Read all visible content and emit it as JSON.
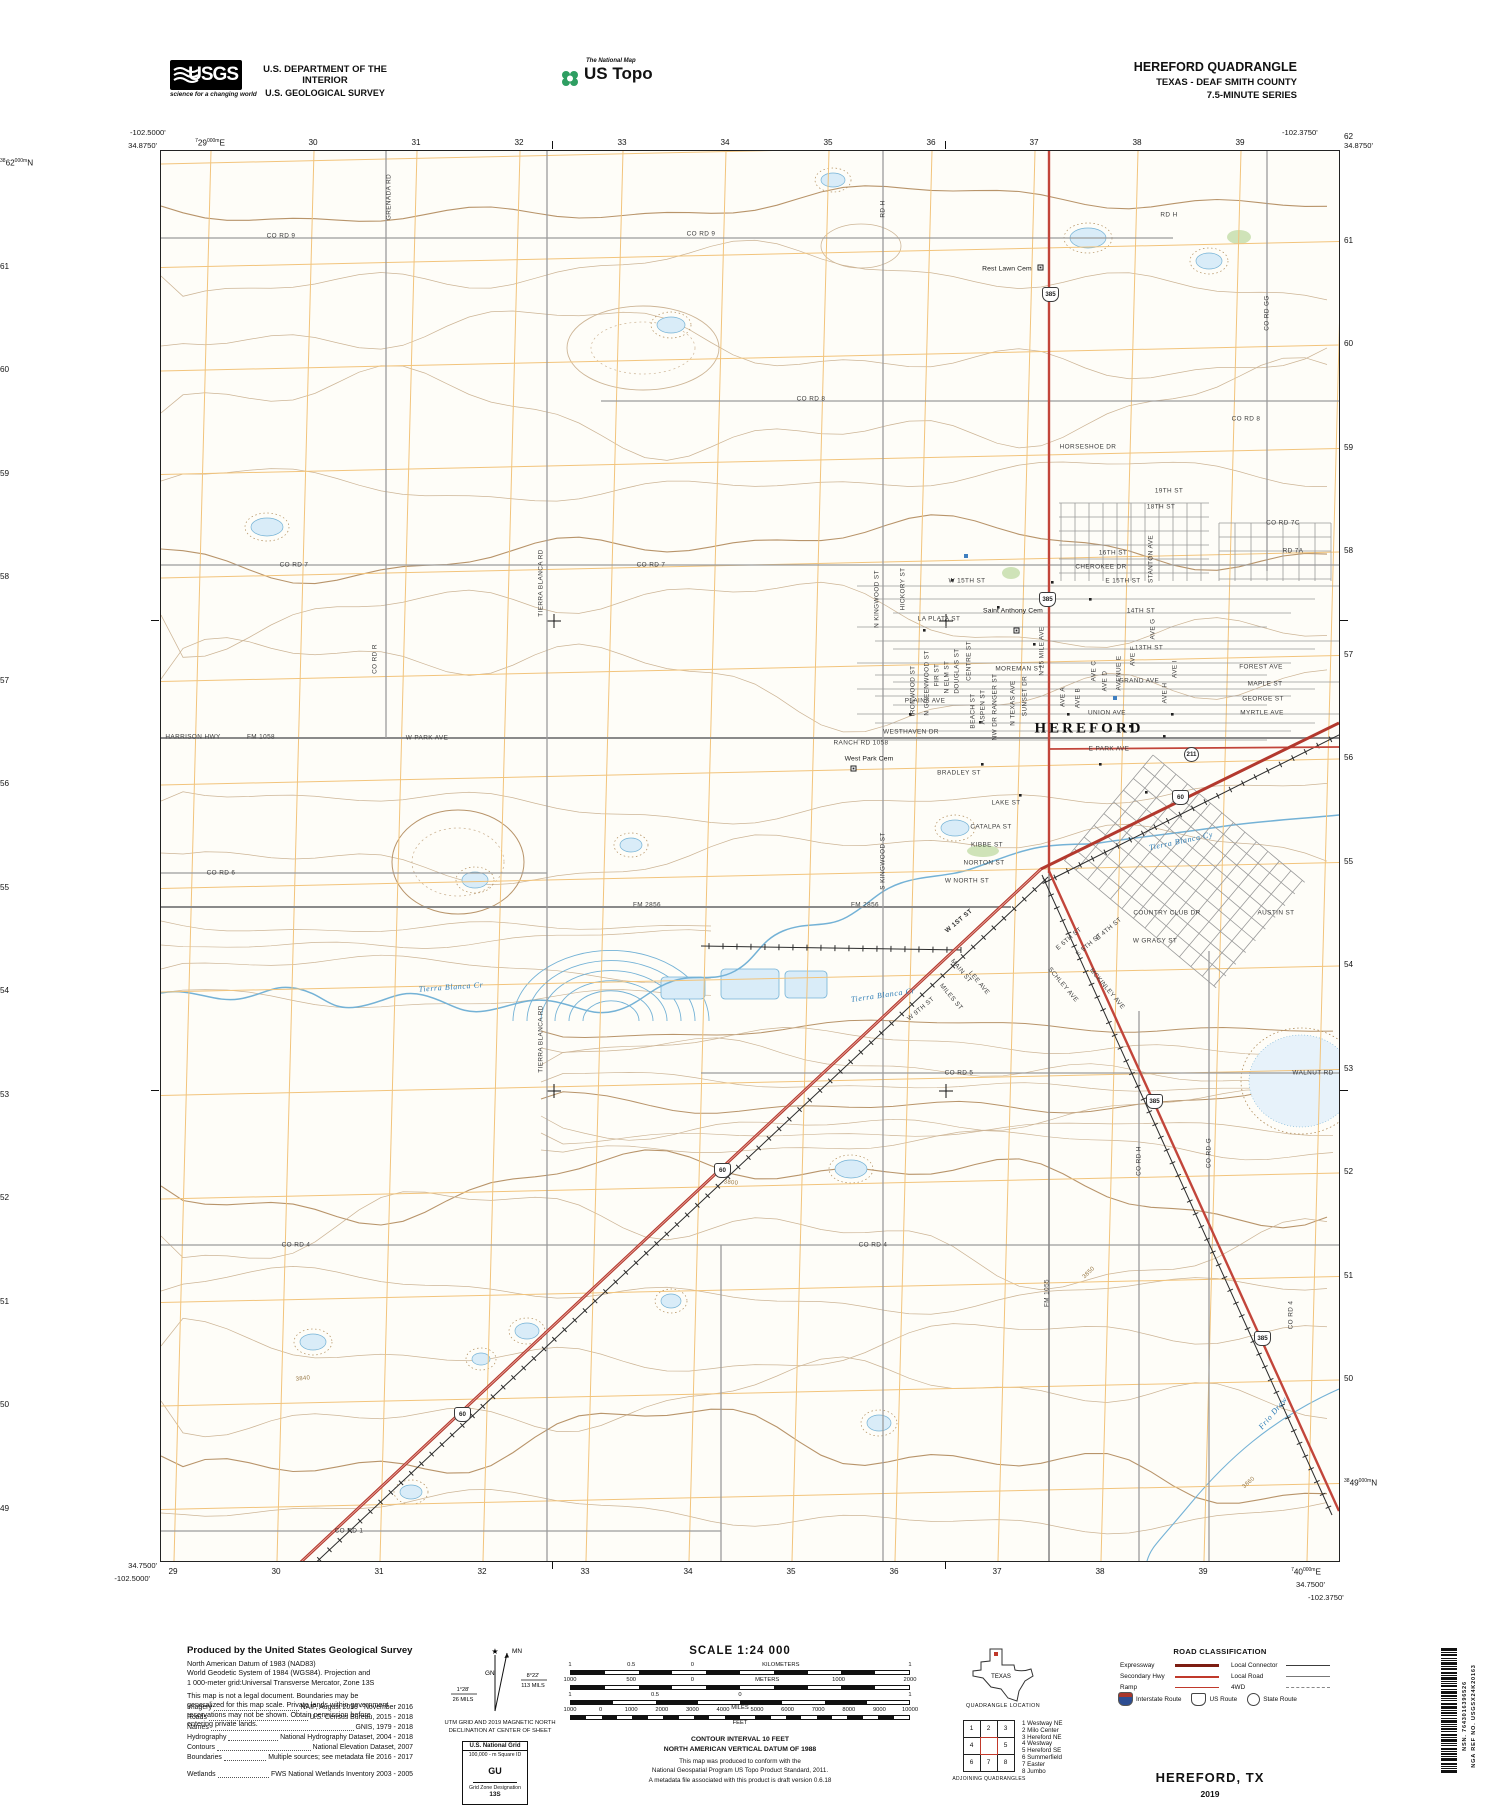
{
  "header": {
    "usgs": {
      "acronym": "USGS",
      "tagline": "science for a changing world"
    },
    "dept1": "U.S. DEPARTMENT OF THE INTERIOR",
    "dept2": "U.S. GEOLOGICAL SURVEY",
    "ustopo": {
      "small": "The National Map",
      "large": "US Topo"
    },
    "quad": {
      "l1": "HEREFORD QUADRANGLE",
      "l2": "TEXAS - DEAF SMITH COUNTY",
      "l3": "7.5-MINUTE SERIES"
    }
  },
  "map": {
    "corners": {
      "tl_lon": "-102.5000'",
      "tl_lat": "34.8750'",
      "tr_lon": "-102.3750'",
      "tr_lat": "34.8750'",
      "bl_lat": "34.7500'",
      "bl_lon": "-102.5000'",
      "br_lat": "34.7500'",
      "br_lon": "-102.3750'"
    },
    "grid": {
      "top": [
        [
          "7",
          "29",
          "000m",
          "E"
        ],
        [
          "",
          "30"
        ],
        [
          "",
          "31"
        ],
        [
          "",
          "32"
        ],
        [
          "",
          "33"
        ],
        [
          "",
          "34"
        ],
        [
          "",
          "35"
        ],
        [
          "",
          "36"
        ],
        [
          "",
          "37"
        ],
        [
          "",
          "38"
        ],
        [
          "",
          "39"
        ]
      ],
      "bottom": [
        [
          "",
          "29"
        ],
        [
          "",
          "30"
        ],
        [
          "",
          "31"
        ],
        [
          "",
          "32"
        ],
        [
          "",
          "33"
        ],
        [
          "",
          "34"
        ],
        [
          "",
          "35"
        ],
        [
          "",
          "36"
        ],
        [
          "",
          "37"
        ],
        [
          "",
          "38"
        ],
        [
          "",
          "39"
        ],
        [
          "7",
          "40",
          "000m",
          "E"
        ]
      ],
      "left": [
        [
          "38",
          "62",
          "000m",
          "N"
        ],
        [
          "",
          "61"
        ],
        [
          "",
          "60"
        ],
        [
          "",
          "59"
        ],
        [
          "",
          "58"
        ],
        [
          "",
          "57"
        ],
        [
          "",
          "56"
        ],
        [
          "",
          "55"
        ],
        [
          "",
          "54"
        ],
        [
          "",
          "53"
        ],
        [
          "",
          "52"
        ],
        [
          "",
          "51"
        ],
        [
          "",
          "50"
        ],
        [
          "",
          "49"
        ]
      ],
      "right": [
        [
          "",
          "62"
        ],
        [
          "",
          "61"
        ],
        [
          "",
          "60"
        ],
        [
          "",
          "59"
        ],
        [
          "",
          "58"
        ],
        [
          "",
          "57"
        ],
        [
          "",
          "56"
        ],
        [
          "",
          "55"
        ],
        [
          "",
          "54"
        ],
        [
          "",
          "53"
        ],
        [
          "",
          "52"
        ],
        [
          "",
          "51"
        ],
        [
          "",
          "50"
        ],
        [
          "38",
          "49",
          "000m",
          "N"
        ]
      ]
    },
    "shields": [
      {
        "n": "385",
        "x": 888,
        "y": 142
      },
      {
        "n": "385",
        "x": 885,
        "y": 447
      },
      {
        "n": "385",
        "x": 992,
        "y": 949
      },
      {
        "n": "385",
        "x": 1100,
        "y": 1186
      },
      {
        "n": "60",
        "x": 1018,
        "y": 645
      },
      {
        "n": "60",
        "x": 560,
        "y": 1018
      },
      {
        "n": "60",
        "x": 300,
        "y": 1262
      },
      {
        "n": "211",
        "x": 1030,
        "y": 602,
        "k": "circle"
      }
    ],
    "labels": [
      {
        "t": "CO RD 9",
        "x": 120,
        "y": 85
      },
      {
        "t": "CO RD 9",
        "x": 540,
        "y": 83
      },
      {
        "t": "GRENADA RD",
        "x": 228,
        "y": 46,
        "r": -90
      },
      {
        "t": "RD H",
        "x": 722,
        "y": 58,
        "r": -90
      },
      {
        "t": "RD H",
        "x": 1008,
        "y": 64
      },
      {
        "t": "Rest Lawn Cem",
        "x": 846,
        "y": 118,
        "c": "place"
      },
      {
        "t": "CO RD 8",
        "x": 650,
        "y": 248
      },
      {
        "t": "CO RD 8",
        "x": 1085,
        "y": 268
      },
      {
        "t": "CO RD GG",
        "x": 1106,
        "y": 162,
        "r": -90
      },
      {
        "t": "HORSESHOE DR",
        "x": 927,
        "y": 296
      },
      {
        "t": "19TH ST",
        "x": 1008,
        "y": 340
      },
      {
        "t": "18TH ST",
        "x": 1000,
        "y": 356
      },
      {
        "t": "CO RD 7C",
        "x": 1122,
        "y": 372
      },
      {
        "t": "RD 7A",
        "x": 1132,
        "y": 400
      },
      {
        "t": "CO RD 7",
        "x": 133,
        "y": 414
      },
      {
        "t": "CO RD 7",
        "x": 490,
        "y": 414
      },
      {
        "t": "W 15TH ST",
        "x": 806,
        "y": 430
      },
      {
        "t": "E 15TH ST",
        "x": 962,
        "y": 430
      },
      {
        "t": "CHEROKEE DR",
        "x": 940,
        "y": 416
      },
      {
        "t": "16TH ST",
        "x": 952,
        "y": 402
      },
      {
        "t": "STANTON AVE",
        "x": 990,
        "y": 408,
        "r": -90
      },
      {
        "t": "Saint Anthony Cem",
        "x": 852,
        "y": 460,
        "c": "place"
      },
      {
        "t": "LA PLATA ST",
        "x": 778,
        "y": 468
      },
      {
        "t": "14TH ST",
        "x": 980,
        "y": 460
      },
      {
        "t": "13TH ST",
        "x": 988,
        "y": 497
      },
      {
        "t": "FOREST AVE",
        "x": 1100,
        "y": 516
      },
      {
        "t": "MAPLE ST",
        "x": 1104,
        "y": 533
      },
      {
        "t": "GEORGE ST",
        "x": 1102,
        "y": 548
      },
      {
        "t": "MYRTLE AVE",
        "x": 1101,
        "y": 562
      },
      {
        "t": "N KINGWOOD ST",
        "x": 716,
        "y": 448,
        "r": -90
      },
      {
        "t": "HICKORY ST",
        "x": 742,
        "y": 438,
        "r": -90
      },
      {
        "t": "IRONWOOD ST",
        "x": 752,
        "y": 540,
        "r": -90
      },
      {
        "t": "N GREENWOOD ST",
        "x": 766,
        "y": 532,
        "r": -90
      },
      {
        "t": "FIR ST",
        "x": 776,
        "y": 524,
        "r": -90
      },
      {
        "t": "N ELM ST",
        "x": 786,
        "y": 526,
        "r": -90
      },
      {
        "t": "DOUGLAS ST",
        "x": 796,
        "y": 520,
        "r": -90
      },
      {
        "t": "CENTRE ST",
        "x": 808,
        "y": 510,
        "r": -90
      },
      {
        "t": "MOREMAN ST",
        "x": 858,
        "y": 518
      },
      {
        "t": "GRAND AVE",
        "x": 978,
        "y": 530
      },
      {
        "t": "AVE C",
        "x": 933,
        "y": 520,
        "r": -90
      },
      {
        "t": "AVE D",
        "x": 944,
        "y": 530,
        "r": -90
      },
      {
        "t": "AVENUE E",
        "x": 958,
        "y": 522,
        "r": -90
      },
      {
        "t": "AVE F",
        "x": 972,
        "y": 505,
        "r": -90
      },
      {
        "t": "AVE G",
        "x": 992,
        "y": 478,
        "r": -90
      },
      {
        "t": "AVE H",
        "x": 1004,
        "y": 542,
        "r": -90
      },
      {
        "t": "AVE I",
        "x": 1014,
        "y": 518,
        "r": -90
      },
      {
        "t": "PLAINS AVE",
        "x": 764,
        "y": 550
      },
      {
        "t": "AVE A",
        "x": 902,
        "y": 546,
        "r": -90
      },
      {
        "t": "AVE B",
        "x": 917,
        "y": 547,
        "r": -90
      },
      {
        "t": "UNION AVE",
        "x": 946,
        "y": 562
      },
      {
        "t": "HEREFORD",
        "x": 928,
        "y": 578,
        "c": "big"
      },
      {
        "t": "WESTHAVEN DR",
        "x": 750,
        "y": 581
      },
      {
        "t": "E PARK AVE",
        "x": 948,
        "y": 598
      },
      {
        "t": "RANCH RD 1058",
        "x": 700,
        "y": 592
      },
      {
        "t": "West Park Cem",
        "x": 708,
        "y": 608,
        "c": "place"
      },
      {
        "t": "HARRISON HWY",
        "x": 32,
        "y": 586
      },
      {
        "t": "FM 1058",
        "x": 100,
        "y": 586
      },
      {
        "t": "W PARK AVE",
        "x": 266,
        "y": 587
      },
      {
        "t": "CO RD R",
        "x": 214,
        "y": 508,
        "r": -90
      },
      {
        "t": "TIERRA BLANCA RD",
        "x": 380,
        "y": 432,
        "r": -90
      },
      {
        "t": "TIERRA BLANCA RD",
        "x": 380,
        "y": 888,
        "r": -90
      },
      {
        "t": "N 25 MILE AVE",
        "x": 881,
        "y": 500,
        "r": -90
      },
      {
        "t": "BRADLEY ST",
        "x": 798,
        "y": 622
      },
      {
        "t": "BEACH ST",
        "x": 812,
        "y": 560,
        "r": -90
      },
      {
        "t": "ASPEN ST",
        "x": 822,
        "y": 556,
        "r": -90
      },
      {
        "t": "NW DR RANGER ST",
        "x": 834,
        "y": 556,
        "r": -90
      },
      {
        "t": "N TEXAS AVE",
        "x": 852,
        "y": 552,
        "r": -90
      },
      {
        "t": "SUNSET DR",
        "x": 864,
        "y": 545,
        "r": -90
      },
      {
        "t": "LAKE ST",
        "x": 845,
        "y": 652
      },
      {
        "t": "CATALPA ST",
        "x": 830,
        "y": 676
      },
      {
        "t": "KIBBE ST",
        "x": 826,
        "y": 694
      },
      {
        "t": "NORTON ST",
        "x": 823,
        "y": 712
      },
      {
        "t": "W NORTH ST",
        "x": 806,
        "y": 730
      },
      {
        "t": "S KINGWOOD ST",
        "x": 722,
        "y": 710,
        "r": -90
      },
      {
        "t": "FM 2856",
        "x": 486,
        "y": 754
      },
      {
        "t": "FM 2856",
        "x": 704,
        "y": 754
      },
      {
        "t": "W 1ST ST",
        "x": 798,
        "y": 770,
        "r": -40,
        "c": "rte"
      },
      {
        "t": "COUNTRY CLUB DR",
        "x": 1006,
        "y": 762
      },
      {
        "t": "W GRACY ST",
        "x": 994,
        "y": 790
      },
      {
        "t": "AUSTIN ST",
        "x": 1115,
        "y": 762
      },
      {
        "t": "E 4TH ST",
        "x": 948,
        "y": 778,
        "r": -40
      },
      {
        "t": "E 5TH ST",
        "x": 928,
        "y": 794,
        "r": -40
      },
      {
        "t": "E 6TH ST",
        "x": 908,
        "y": 788,
        "r": -40
      },
      {
        "t": "MAIN ST",
        "x": 800,
        "y": 820,
        "r": 50
      },
      {
        "t": "LEE AVE",
        "x": 818,
        "y": 832,
        "r": 50
      },
      {
        "t": "MILES ST",
        "x": 790,
        "y": 846,
        "r": 50
      },
      {
        "t": "SCHLEY AVE",
        "x": 902,
        "y": 834,
        "r": 50
      },
      {
        "t": "MCKINLEY AVE",
        "x": 946,
        "y": 838,
        "r": 50
      },
      {
        "t": "W 9TH ST",
        "x": 760,
        "y": 858,
        "r": -40
      },
      {
        "t": "Tierra Blanca Cr",
        "x": 290,
        "y": 836,
        "c": "wat",
        "r": -4
      },
      {
        "t": "Tierra Blanca Cr",
        "x": 722,
        "y": 844,
        "c": "wat",
        "r": -8
      },
      {
        "t": "Tierra Blanca Cy",
        "x": 1020,
        "y": 690,
        "c": "wat",
        "r": -12
      },
      {
        "t": "CO RD 5",
        "x": 798,
        "y": 922
      },
      {
        "t": "WALNUT RD",
        "x": 1152,
        "y": 922
      },
      {
        "t": "CO RD 6",
        "x": 60,
        "y": 722
      },
      {
        "t": "CO RD 4",
        "x": 135,
        "y": 1094
      },
      {
        "t": "CO RD 4",
        "x": 712,
        "y": 1094
      },
      {
        "t": "CO RD 4",
        "x": 1130,
        "y": 1164,
        "r": -90
      },
      {
        "t": "CO RD H",
        "x": 978,
        "y": 1010,
        "r": -90
      },
      {
        "t": "CO RD G",
        "x": 1048,
        "y": 1002,
        "r": -90
      },
      {
        "t": "FM 1055",
        "x": 886,
        "y": 1142,
        "r": -90
      },
      {
        "t": "CO RD 1",
        "x": 188,
        "y": 1380
      },
      {
        "t": "3850",
        "x": 928,
        "y": 1122,
        "r": -44,
        "c": "cont"
      },
      {
        "t": "3800",
        "x": 570,
        "y": 1032,
        "r": 5,
        "c": "cont"
      },
      {
        "t": "3840",
        "x": 142,
        "y": 1228,
        "r": -6,
        "c": "cont"
      },
      {
        "t": "3860",
        "x": 1088,
        "y": 1332,
        "r": -42,
        "c": "cont"
      },
      {
        "t": "Frio Draw",
        "x": 1112,
        "y": 1262,
        "r": -50,
        "c": "wat"
      }
    ]
  },
  "footer": {
    "produced": {
      "heading": "Produced by the United States Geological Survey",
      "datum": "North American Datum of 1983 (NAD83)\nWorld Geodetic System of 1984 (WGS84).  Projection and\n1 000-meter grid:Universal Transverse Mercator, Zone 13S",
      "legal": "This map is not a legal document. Boundaries may be\ngeneralized for this map scale. Private lands within government\nreservations may not be shown. Obtain permission before\nentering private lands."
    },
    "credits": [
      {
        "label": "Imagery",
        "value": "NAIP, August 2016 - November 2016"
      },
      {
        "label": "Roads",
        "value": "U.S. Census Bureau, 2015 - 2018"
      },
      {
        "label": "Names",
        "value": "GNIS, 1979 - 2018"
      },
      {
        "label": "Hydrography",
        "value": "National Hydrography Dataset, 2004 - 2018"
      },
      {
        "label": "Contours",
        "value": "National Elevation Dataset, 2007"
      },
      {
        "label": "Boundaries",
        "value": "Multiple sources; see metadata file 2016 - 2017"
      },
      {
        "label": "Wetlands",
        "value": "FWS National Wetlands Inventory 2003 - 2005"
      }
    ],
    "decl": {
      "star": "★",
      "gn": "GN",
      "mn": "MN",
      "l1": "1°28'",
      "l2": "26 MILS",
      "r1": "8°22'",
      "r2": "113 MILS",
      "cap": "UTM GRID AND 2019 MAGNETIC NORTH\nDECLINATION AT CENTER OF SHEET"
    },
    "usng": {
      "title": "U.S. National Grid",
      "sub": "100,000 - m Square ID",
      "square": "GU",
      "zone_label": "Grid Zone Designation",
      "zone": "13S"
    },
    "scale": {
      "title": "SCALE 1:24 000",
      "rows": [
        {
          "labels": [
            "1",
            "0.5",
            "0",
            "KILOMETERS",
            "1"
          ]
        },
        {
          "labels": [
            "1000",
            "500",
            "0",
            "METERS",
            "1000",
            "2000"
          ]
        },
        {
          "labels": [
            "1",
            "0.5",
            "0",
            "1"
          ],
          "below": "MILES"
        },
        {
          "labels": [
            "1000",
            "0",
            "1000",
            "2000",
            "3000",
            "4000",
            "5000",
            "6000",
            "7000",
            "8000",
            "9000",
            "10000"
          ],
          "below": "FEET"
        }
      ]
    },
    "notes": {
      "contour": "CONTOUR INTERVAL 10 FEET\nNORTH AMERICAN VERTICAL DATUM OF 1988",
      "conform": "This map was produced to conform with the\nNational Geospatial Program US Topo Product Standard, 2011.\nA metadata file associated with this product is draft version 0.6.18"
    },
    "quadloc": {
      "state": "TEXAS",
      "caption": "QUADRANGLE LOCATION"
    },
    "adjoining": {
      "cells": [
        "1",
        "2",
        "3",
        "4",
        "",
        "5",
        "6",
        "7",
        "8"
      ],
      "caption": "ADJOINING QUADRANGLES",
      "list": [
        "1 Westway NE",
        "2 Milo Center",
        "3 Hereford NE",
        "4 Westway",
        "5 Hereford SE",
        "6 Summerfield",
        "7 Easter",
        "8 Jumbo"
      ]
    },
    "roadclass": {
      "title": "ROAD CLASSIFICATION",
      "left": [
        "Expressway",
        "Secondary Hwy",
        "Ramp"
      ],
      "right": [
        "Local Connector",
        "Local Road",
        "4WD"
      ],
      "shields": [
        "Interstate Route",
        "US Route",
        "State Route"
      ]
    },
    "title": {
      "name": "HEREFORD,  TX",
      "year": "2019"
    },
    "barcode": {
      "nsn": "NSN. 7643016396526",
      "nga": "NGA REF NO. USGSX24K20163"
    }
  }
}
